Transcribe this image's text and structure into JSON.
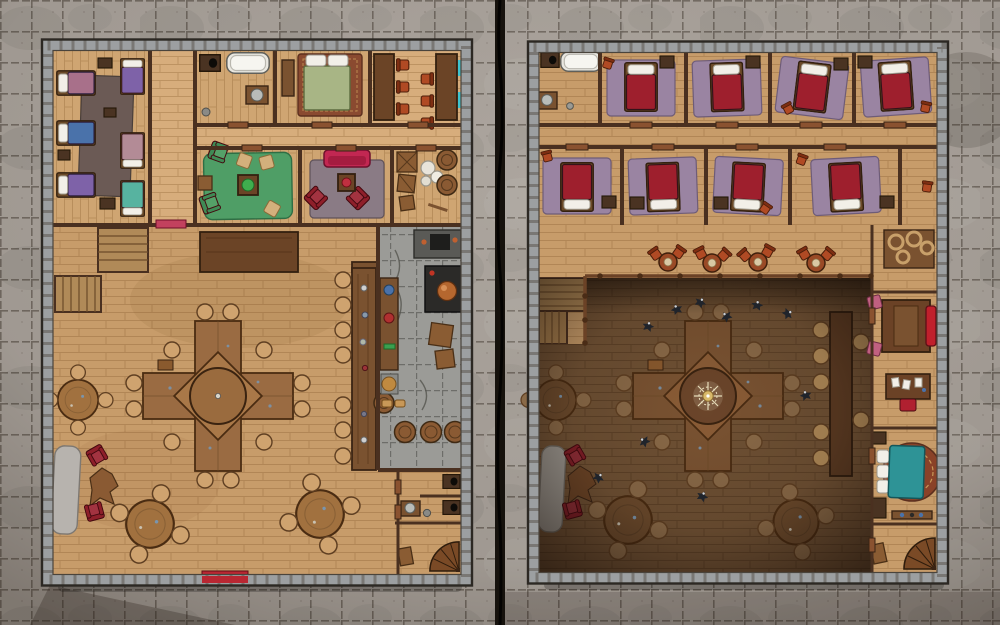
{
  "map": {
    "kind": "two-page tavern battle map, top-down",
    "grid_cell_px": 31,
    "panels": [
      {
        "id": "ground-floor",
        "rooms": [
          "dormitory",
          "bathroom",
          "bedroom",
          "private-dining-room",
          "green-lounge",
          "red-lounge",
          "storage-room",
          "great-hall",
          "bar",
          "kitchen",
          "privies",
          "spiral-stair-room"
        ],
        "furniture": [
          "six-beds",
          "dark-rug",
          "bathtub",
          "privy-box",
          "washstand",
          "green-bed",
          "ornate-rug",
          "long-dining-tables",
          "red-chairs",
          "green-armchairs",
          "plant-table",
          "crimson-sofa",
          "red-armchairs",
          "crates",
          "barrels",
          "sacks",
          "cross-banquet-table",
          "round-tables",
          "stools",
          "bar-counter",
          "bar-stools",
          "stove",
          "prep-counters",
          "fur-rug",
          "hide-rug",
          "spiral-staircase",
          "red-doormat",
          "stairs"
        ]
      },
      {
        "id": "upper-floor",
        "rooms": [
          "bath-closet",
          "guest-room-1",
          "guest-room-2",
          "guest-room-3",
          "guest-room-4",
          "guest-room-5",
          "guest-room-6",
          "guest-room-7",
          "guest-room-8",
          "corridor-seating",
          "balcony",
          "open-atrium",
          "office-suite",
          "teal-bedroom",
          "spiral-stair-room"
        ],
        "furniture": [
          "bathtub",
          "privy-box",
          "eight-red-beds",
          "purple-rugs",
          "nightstands",
          "orange-stools",
          "cafe-tables",
          "balcony-railing",
          "stairs",
          "chandelier",
          "cross-banquet-table-below",
          "round-tables-below",
          "ravens",
          "ledge-counter",
          "office-bed",
          "red-sofa",
          "pink-chairs",
          "writing-desk",
          "desk-chair",
          "teal-bed",
          "round-ornate-rug",
          "dressers",
          "spiral-staircase"
        ]
      }
    ]
  },
  "palette": {
    "stone_bg": "#a7a099",
    "stone_line": "#5e564e",
    "seam": "#16120d",
    "wall_stone": "#9c9fa1",
    "wall_edge": "#2c2823",
    "wall_wood": "#4a3020",
    "wood_hall": "#c79c6a",
    "wood_room": "#cfa572",
    "wood_light": "#d7ad7c",
    "wood_dark_floor": "#6f5134",
    "plank_line": "#a87e4d",
    "plank_line_dark": "#5a3f26",
    "table_wood": "#9a6b42",
    "table_edge": "#53351d",
    "stool": "#cfa36f",
    "stool_dark": "#8a6a48",
    "stool_edge": "#5f3f22",
    "bar_wood": "#7a5230",
    "counter_front": "#6b4426",
    "door_wood": "#8a5230",
    "rug_gray": "#6b5a55",
    "rug_purple": "#9a84a2",
    "rug_green": "#4f9e66",
    "rug_mauve": "#8a7b85",
    "rug_red": "#8a4a30",
    "rug_round": "#8a4228",
    "bed_red": "#9e1f2d",
    "bed_blue": "#4a72aa",
    "bed_purple": "#7e62a8",
    "bed_mauve": "#a8708a",
    "bed_pink": "#b38b96",
    "bed_teal": "#57b3a0",
    "bed_green": "#a8b585",
    "bed_cyan": "#2e9396",
    "pillow": "#f2efe8",
    "white": "#f2efe8",
    "sofa_crimson": "#c22752",
    "chair_red": "#8e1f2a",
    "chair_orange": "#b04a24",
    "chair_pink": "#c06080",
    "sofa_red": "#c0202c",
    "green_chair": "#3f8a55",
    "crate": "#8a5c33",
    "crate_edge": "#4a2f16",
    "barrel": "#8a5a33",
    "barrel_edge": "#3f2a14",
    "kitchen_stone": "#9b9b97",
    "kitchen_line": "#62625e",
    "stove": "#2b2a28",
    "copper": "#b5672f",
    "fur_rug": "#b7b3ae",
    "hide_rug": "#8a5a33",
    "window": "#3ec4cf",
    "doormat": "#b92732",
    "bird": "#20242b",
    "chandelier": "#ece2c0",
    "gold": "#d8b96a"
  }
}
